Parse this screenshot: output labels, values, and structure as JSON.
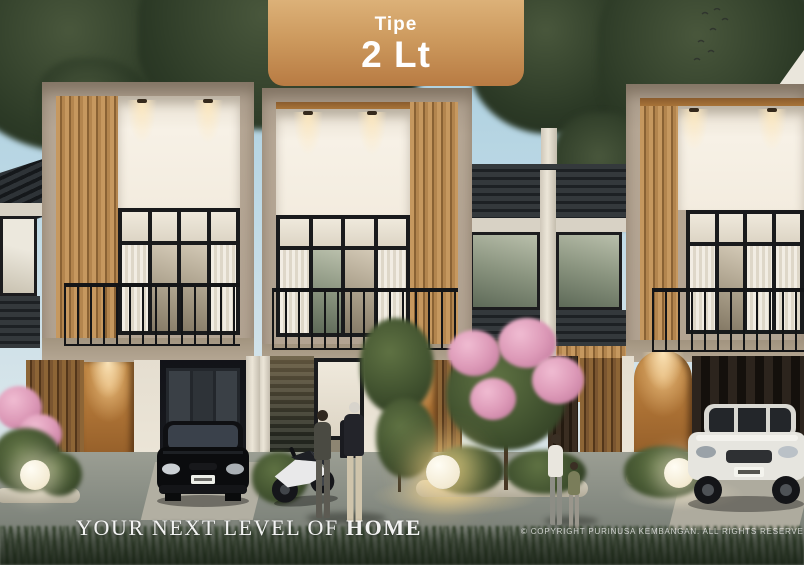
{
  "banner": {
    "type_label": "Tipe",
    "type_value": "2 Lt",
    "gradient_top": "#dcb178",
    "gradient_bottom": "#b87b43",
    "text_color": "#ffffff"
  },
  "footer": {
    "tagline_prefix": "YOUR NEXT LEVEL OF ",
    "tagline_emphasis": "HOME",
    "copyright": "© COPYRIGHT PURINUSA KEMBANGAN. ALL RIGHTS RESERVED"
  },
  "palette": {
    "sky": "#b7d6e4",
    "tree_foliage": "#2c3a26",
    "frame_beige": "#b2a392",
    "wood_slat_light": "#c6985f",
    "wood_slat_dark": "#53361a",
    "roof_tile": "#24282b",
    "white_wall": "#f5efe4",
    "door_wood": "#a96f33",
    "road_gray": "#7d827c",
    "lamp_glow": "#ffdb8c",
    "flower_pink": "#dd9ab8"
  },
  "scene": {
    "units_visible": 3,
    "storeys": 2
  }
}
